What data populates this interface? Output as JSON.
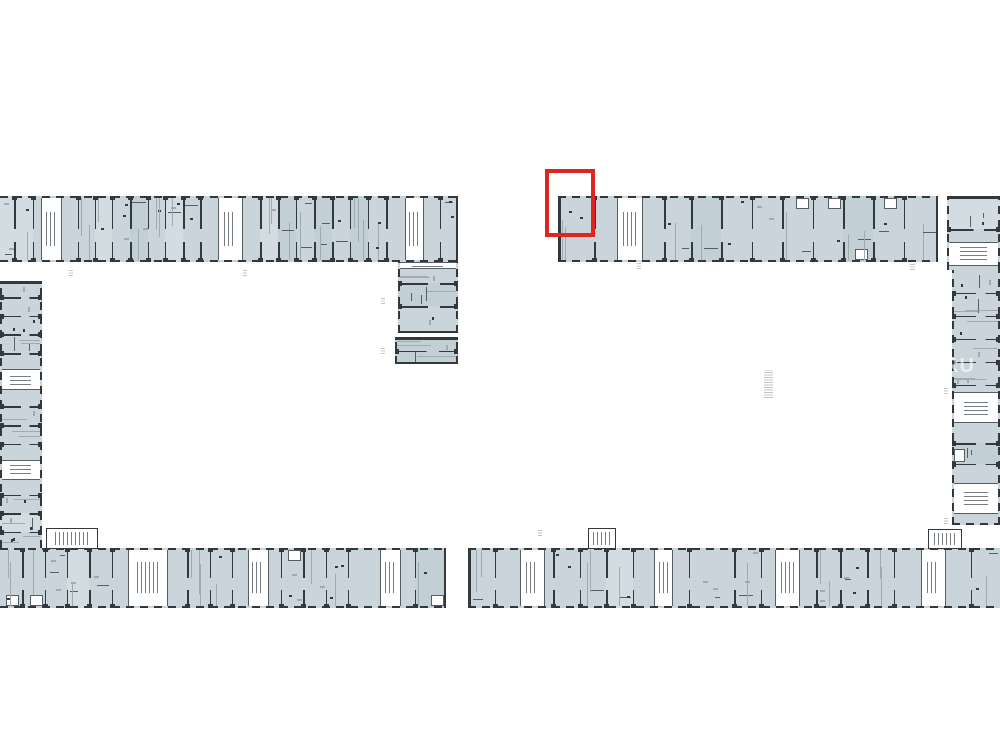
{
  "meta": {
    "background": "#ffffff",
    "canvas_w": 1000,
    "canvas_h": 750
  },
  "colors": {
    "room_fill": "#c9d5db",
    "room_fill_dark": "#bccbd3",
    "wall": "#32383d",
    "wall_soft": "#565d63",
    "line_light": "#9fabb1",
    "speck": "#6f787e",
    "core_white": "#ffffff",
    "highlight_red": "#e02420",
    "mark_gray": "#8d959b"
  },
  "watermark": {
    "text": "RU",
    "x": 944,
    "y": 356
  },
  "highlight": {
    "x": 545,
    "y": 169,
    "w": 50,
    "h": 68,
    "stroke": 4
  },
  "plan": {
    "strips": [
      {
        "id": "left-top",
        "o": "h",
        "x": 0,
        "y": 196,
        "w": 458,
        "h": 66,
        "capStart": false,
        "capEnd": true,
        "dividers": [
          0.031,
          0.072,
          0.17,
          0.207,
          0.244,
          0.284,
          0.323,
          0.36,
          0.4,
          0.437,
          0.568,
          0.607,
          0.646,
          0.686,
          0.725,
          0.764,
          0.803,
          0.843,
          0.96
        ],
        "cores": [
          [
            0.09,
            0.135
          ],
          [
            0.476,
            0.53
          ],
          [
            0.884,
            0.926
          ]
        ]
      },
      {
        "id": "wing-upper",
        "o": "v",
        "x": 398,
        "y": 262,
        "w": 60,
        "h": 71,
        "capStart": false,
        "capEnd": true,
        "dividers": [
          0.3,
          0.62
        ],
        "cores": [
          [
            0.0,
            0.1
          ]
        ]
      },
      {
        "id": "wing-lower",
        "o": "v",
        "x": 395,
        "y": 337,
        "w": 63,
        "h": 27,
        "capStart": true,
        "capEnd": true,
        "dividers": [
          0.5
        ],
        "cores": []
      },
      {
        "id": "left-wing",
        "o": "v",
        "x": 0,
        "y": 281,
        "w": 42,
        "h": 267,
        "capStart": true,
        "capEnd": false,
        "dividers": [
          0.06,
          0.13,
          0.2,
          0.27,
          0.47,
          0.54,
          0.61,
          0.8,
          0.87,
          0.94
        ],
        "cores": [
          [
            0.33,
            0.41
          ],
          [
            0.67,
            0.745
          ]
        ]
      },
      {
        "id": "left-bottom",
        "o": "h",
        "x": 0,
        "y": 548,
        "w": 446,
        "h": 60,
        "capStart": false,
        "capEnd": true,
        "dividers": [
          0.05,
          0.1,
          0.15,
          0.2,
          0.25,
          0.42,
          0.47,
          0.52,
          0.63,
          0.68,
          0.73,
          0.78,
          0.93
        ],
        "cores": [
          [
            0.287,
            0.377
          ],
          [
            0.555,
            0.603
          ],
          [
            0.853,
            0.898
          ]
        ]
      },
      {
        "id": "right-top",
        "o": "h",
        "x": 558,
        "y": 196,
        "w": 380,
        "h": 66,
        "capStart": true,
        "capEnd": true,
        "dividers": [
          0.095,
          0.28,
          0.35,
          0.43,
          0.51,
          0.59,
          0.67,
          0.75,
          0.83,
          0.91
        ],
        "cores": [
          [
            0.155,
            0.225
          ]
        ]
      },
      {
        "id": "right-corner",
        "o": "v",
        "x": 947,
        "y": 196,
        "w": 53,
        "h": 74,
        "capStart": true,
        "capEnd": false,
        "dividers": [
          0.45
        ],
        "cores": [
          [
            0.62,
            0.95
          ]
        ]
      },
      {
        "id": "right-wing",
        "o": "v",
        "x": 952,
        "y": 270,
        "w": 48,
        "h": 255,
        "capStart": false,
        "capEnd": true,
        "capEndDash": true,
        "dividers": [
          0.09,
          0.18,
          0.27,
          0.36,
          0.45,
          0.68,
          0.76
        ],
        "cores": [
          [
            0.48,
            0.6
          ],
          [
            0.835,
            0.955
          ]
        ]
      },
      {
        "id": "right-bottom",
        "o": "h",
        "x": 468,
        "y": 548,
        "w": 532,
        "h": 60,
        "capStart": true,
        "capEnd": false,
        "dividers": [
          0.05,
          0.16,
          0.21,
          0.26,
          0.31,
          0.415,
          0.5,
          0.55,
          0.655,
          0.7,
          0.75,
          0.8,
          0.945
        ],
        "cores": [
          [
            0.098,
            0.145
          ],
          [
            0.35,
            0.385
          ],
          [
            0.578,
            0.625
          ],
          [
            0.852,
            0.898
          ]
        ]
      }
    ],
    "annexes": [
      {
        "x": 46,
        "y": 528,
        "w": 52,
        "h": 21
      },
      {
        "x": 588,
        "y": 528,
        "w": 28,
        "h": 21
      },
      {
        "x": 928,
        "y": 529,
        "w": 34,
        "h": 20
      }
    ],
    "marks": [
      {
        "x": 69,
        "y": 270,
        "w": 4,
        "h": 6
      },
      {
        "x": 243,
        "y": 270,
        "w": 4,
        "h": 6
      },
      {
        "x": 381,
        "y": 298,
        "w": 4,
        "h": 6
      },
      {
        "x": 381,
        "y": 348,
        "w": 4,
        "h": 6
      },
      {
        "x": 538,
        "y": 530,
        "w": 4,
        "h": 6
      },
      {
        "x": 637,
        "y": 263,
        "w": 4,
        "h": 6
      },
      {
        "x": 764,
        "y": 370,
        "w": 9,
        "h": 28
      },
      {
        "x": 910,
        "y": 264,
        "w": 5,
        "h": 6
      },
      {
        "x": 944,
        "y": 388,
        "w": 4,
        "h": 6
      },
      {
        "x": 944,
        "y": 518,
        "w": 4,
        "h": 6
      }
    ]
  }
}
